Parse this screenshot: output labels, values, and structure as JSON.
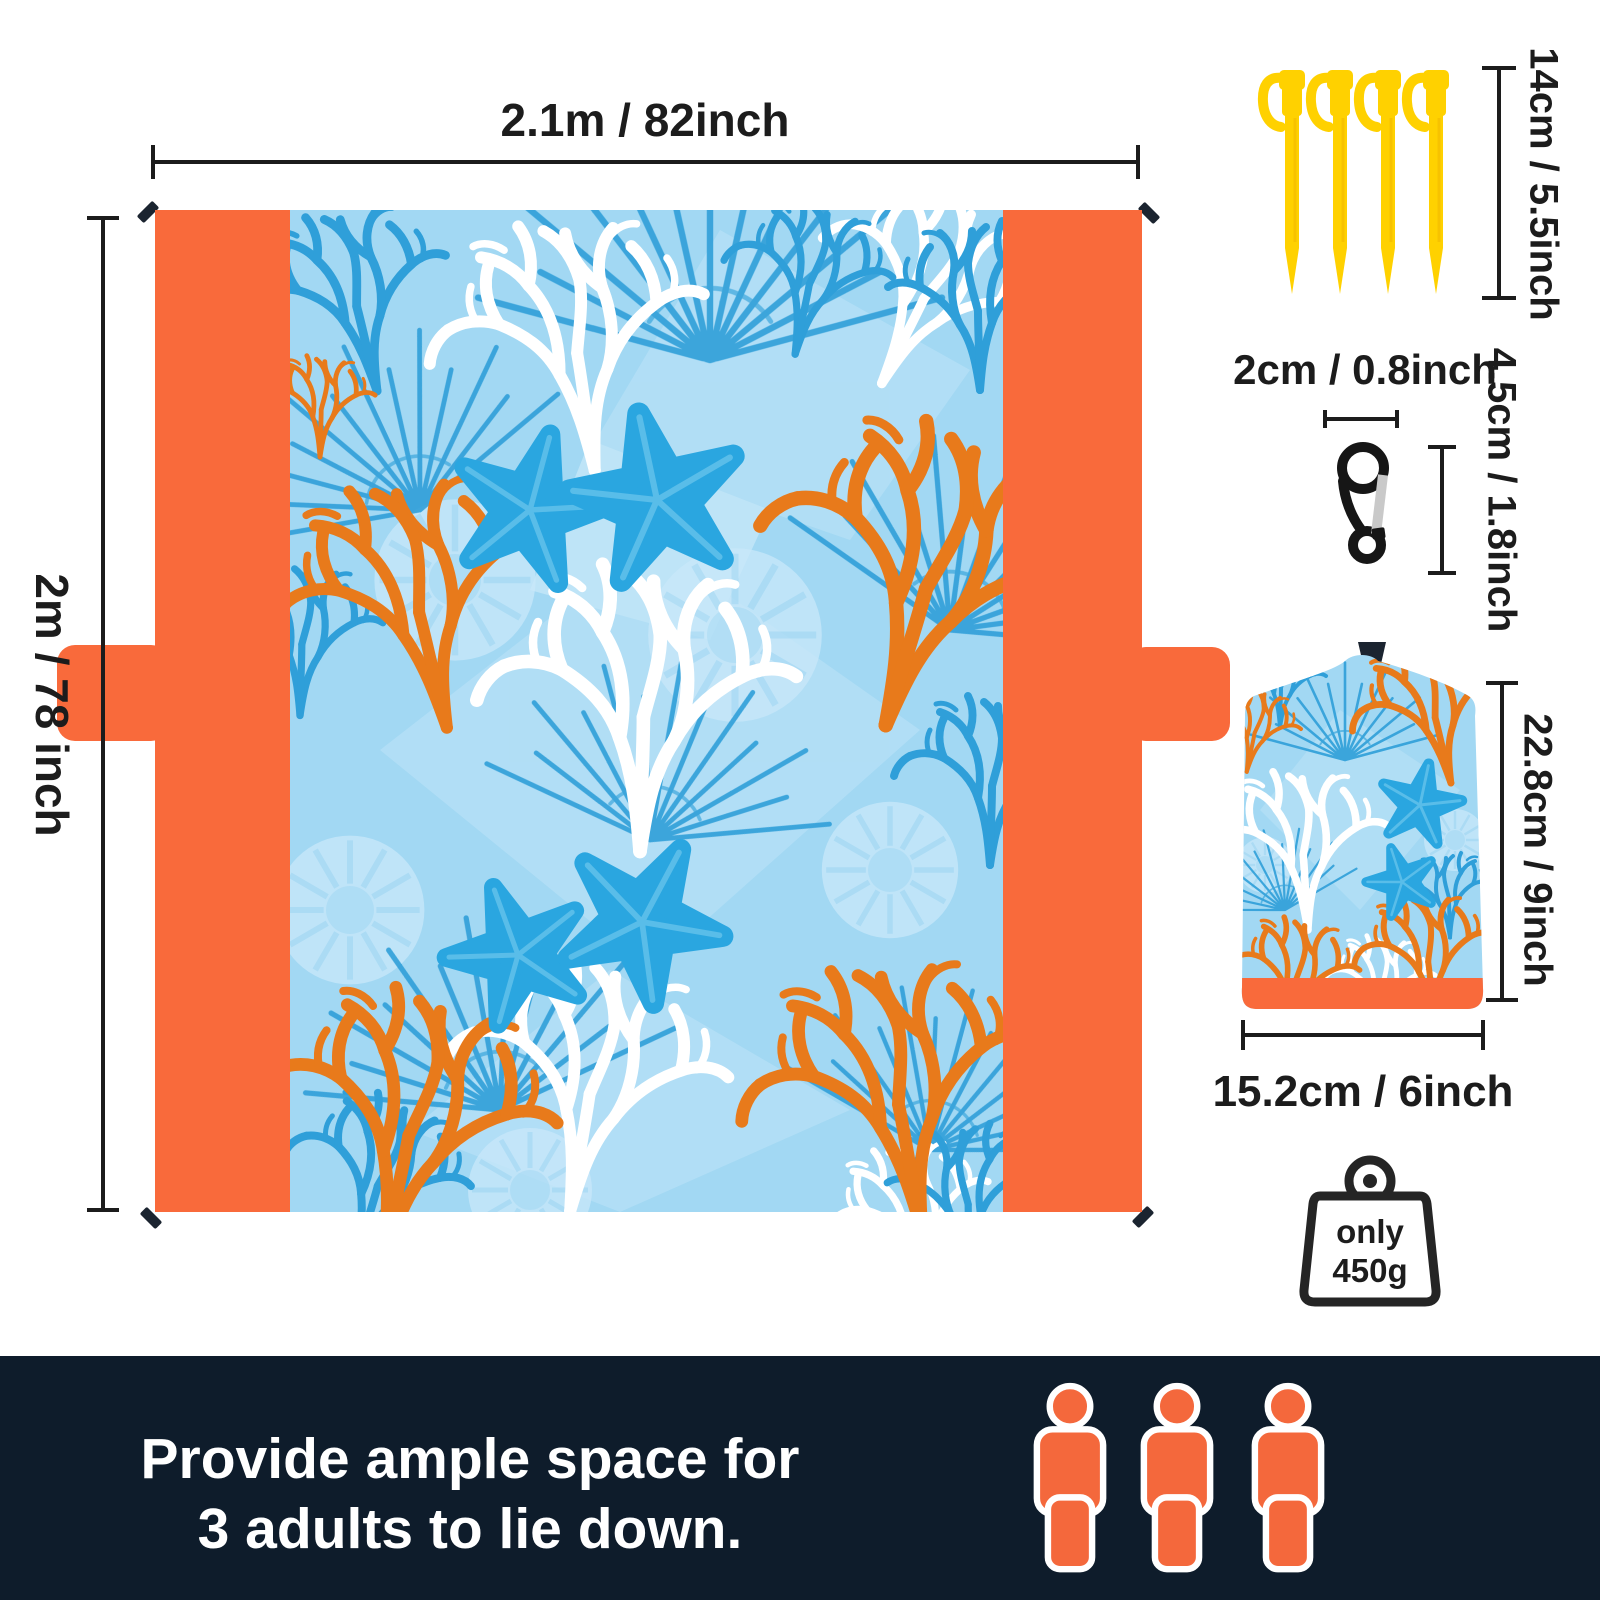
{
  "product": "beach blanket infographic",
  "blanket": {
    "width_label": "2.1m / 82inch",
    "height_label": "2m / 78 inch",
    "corner_ties": 4,
    "side_tabs": 2,
    "pattern_motifs": [
      "white coral",
      "orange coral",
      "blue coral",
      "blue starfish",
      "pale shells"
    ]
  },
  "stakes": {
    "count": 4,
    "length_label": "14cm / 5.5inch"
  },
  "carabiner": {
    "width_label": "2cm / 0.8inch",
    "height_label": "4.5cm / 1.8inch"
  },
  "bag": {
    "height_label": "22.8cm / 9inch",
    "width_label": "15.2cm / 6inch"
  },
  "weight": {
    "line1": "only",
    "line2": "450g"
  },
  "banner": {
    "line1": "Provide ample space for",
    "line2": "3 adults to lie down.",
    "person_count": 3
  },
  "colors": {
    "accent_orange": "#F96A3B",
    "pattern_bg": "#A2D8F3",
    "coral_orange": "#E87A1B",
    "coral_blue": "#2F9FD9",
    "starfish_blue": "#2AA6E0",
    "coral_white": "#FFFFFF",
    "shell_pale": "#C9E8FA",
    "stake_yellow": "#FFD100",
    "banner_bg": "#0E1C2B",
    "person_orange": "#F4683C",
    "dim_color": "#1C1C1C"
  }
}
